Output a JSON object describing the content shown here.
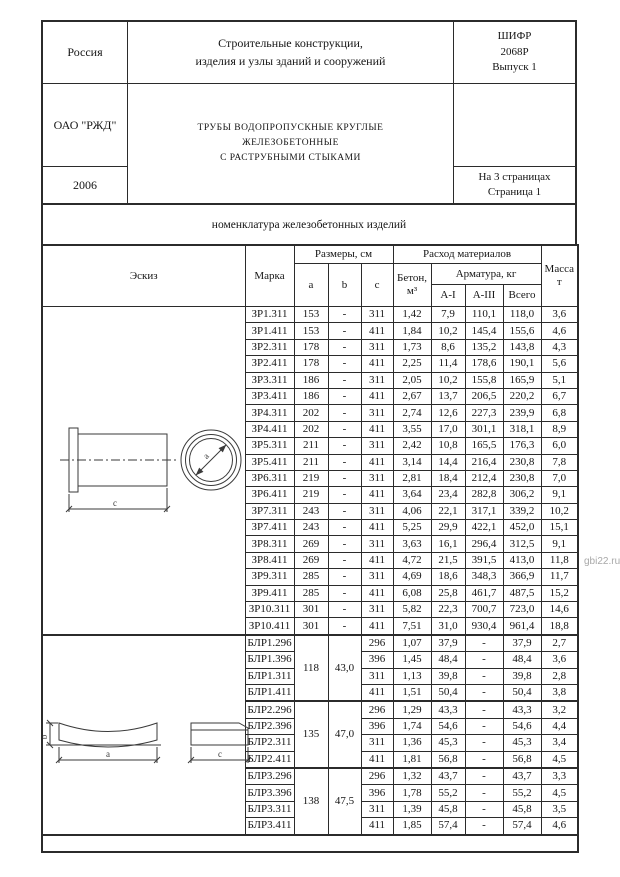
{
  "header": {
    "country": "Россия",
    "organization": "ОАО \"РЖД\"",
    "year": "2006",
    "series_title": "Строительные конструкции,\nизделия и узлы зданий и сооружений",
    "doc_title": "ТРУБЫ ВОДОПРОПУСКНЫЕ КРУГЛЫЕ\nЖЕЛЕЗОБЕТОННЫЕ\nС РАСТРУБНЫМИ СТЫКАМИ",
    "cipher": "ШИФР\n2068Р\nВыпуск 1",
    "pages": "На 3 страницах\nСтраница 1"
  },
  "section_title": "номенклатура железобетонных изделий",
  "table": {
    "columns": {
      "sketch": "Эскиз",
      "mark": "Марка",
      "dims": "Размеры, см",
      "a": "a",
      "b": "b",
      "c": "c",
      "consumption": "Расход материалов",
      "concrete": "Бетон,\nм³",
      "rebar": "Арматура, кг",
      "ai": "А-I",
      "aiii": "А-III",
      "total": "Всего",
      "mass": "Масса\nт"
    },
    "zr_rows": [
      [
        "ЗР1.311",
        "153",
        "-",
        "311",
        "1,42",
        "7,9",
        "110,1",
        "118,0",
        "3,6"
      ],
      [
        "ЗР1.411",
        "153",
        "-",
        "411",
        "1,84",
        "10,2",
        "145,4",
        "155,6",
        "4,6"
      ],
      [
        "ЗР2.311",
        "178",
        "-",
        "311",
        "1,73",
        "8,6",
        "135,2",
        "143,8",
        "4,3"
      ],
      [
        "ЗР2.411",
        "178",
        "-",
        "411",
        "2,25",
        "11,4",
        "178,6",
        "190,1",
        "5,6"
      ],
      [
        "ЗР3.311",
        "186",
        "-",
        "311",
        "2,05",
        "10,2",
        "155,8",
        "165,9",
        "5,1"
      ],
      [
        "ЗР3.411",
        "186",
        "-",
        "411",
        "2,67",
        "13,7",
        "206,5",
        "220,2",
        "6,7"
      ],
      [
        "ЗР4.311",
        "202",
        "-",
        "311",
        "2,74",
        "12,6",
        "227,3",
        "239,9",
        "6,8"
      ],
      [
        "ЗР4.411",
        "202",
        "-",
        "411",
        "3,55",
        "17,0",
        "301,1",
        "318,1",
        "8,9"
      ],
      [
        "ЗР5.311",
        "211",
        "-",
        "311",
        "2,42",
        "10,8",
        "165,5",
        "176,3",
        "6,0"
      ],
      [
        "ЗР5.411",
        "211",
        "-",
        "411",
        "3,14",
        "14,4",
        "216,4",
        "230,8",
        "7,8"
      ],
      [
        "ЗР6.311",
        "219",
        "-",
        "311",
        "2,81",
        "18,4",
        "212,4",
        "230,8",
        "7,0"
      ],
      [
        "ЗР6.411",
        "219",
        "-",
        "411",
        "3,64",
        "23,4",
        "282,8",
        "306,2",
        "9,1"
      ],
      [
        "ЗР7.311",
        "243",
        "-",
        "311",
        "4,06",
        "22,1",
        "317,1",
        "339,2",
        "10,2"
      ],
      [
        "ЗР7.411",
        "243",
        "-",
        "411",
        "5,25",
        "29,9",
        "422,1",
        "452,0",
        "15,1"
      ],
      [
        "ЗР8.311",
        "269",
        "-",
        "311",
        "3,63",
        "16,1",
        "296,4",
        "312,5",
        "9,1"
      ],
      [
        "ЗР8.411",
        "269",
        "-",
        "411",
        "4,72",
        "21,5",
        "391,5",
        "413,0",
        "11,8"
      ],
      [
        "ЗР9.311",
        "285",
        "-",
        "311",
        "4,69",
        "18,6",
        "348,3",
        "366,9",
        "11,7"
      ],
      [
        "ЗР9.411",
        "285",
        "-",
        "411",
        "6,08",
        "25,8",
        "461,7",
        "487,5",
        "15,2"
      ],
      [
        "ЗР10.311",
        "301",
        "-",
        "311",
        "5,82",
        "22,3",
        "700,7",
        "723,0",
        "14,6"
      ],
      [
        "ЗР10.411",
        "301",
        "-",
        "411",
        "7,51",
        "31,0",
        "930,4",
        "961,4",
        "18,8"
      ]
    ],
    "blr_groups": [
      {
        "a": "118",
        "b": "43,0",
        "rows": [
          [
            "БЛР1.296",
            "296",
            "1,07",
            "37,9",
            "-",
            "37,9",
            "2,7"
          ],
          [
            "БЛР1.396",
            "396",
            "1,45",
            "48,4",
            "-",
            "48,4",
            "3,6"
          ],
          [
            "БЛР1.311",
            "311",
            "1,13",
            "39,8",
            "-",
            "39,8",
            "2,8"
          ],
          [
            "БЛР1.411",
            "411",
            "1,51",
            "50,4",
            "-",
            "50,4",
            "3,8"
          ]
        ]
      },
      {
        "a": "135",
        "b": "47,0",
        "rows": [
          [
            "БЛР2.296",
            "296",
            "1,29",
            "43,3",
            "-",
            "43,3",
            "3,2"
          ],
          [
            "БЛР2.396",
            "396",
            "1,74",
            "54,6",
            "-",
            "54,6",
            "4,4"
          ],
          [
            "БЛР2.311",
            "311",
            "1,36",
            "45,3",
            "-",
            "45,3",
            "3,4"
          ],
          [
            "БЛР2.411",
            "411",
            "1,81",
            "56,8",
            "-",
            "56,8",
            "4,5"
          ]
        ]
      },
      {
        "a": "138",
        "b": "47,5",
        "rows": [
          [
            "БЛР3.296",
            "296",
            "1,32",
            "43,7",
            "-",
            "43,7",
            "3,3"
          ],
          [
            "БЛР3.396",
            "396",
            "1,78",
            "55,2",
            "-",
            "55,2",
            "4,5"
          ],
          [
            "БЛР3.311",
            "311",
            "1,39",
            "45,8",
            "-",
            "45,8",
            "3,5"
          ],
          [
            "БЛР3.411",
            "411",
            "1,85",
            "57,4",
            "-",
            "57,4",
            "4,6"
          ]
        ]
      }
    ]
  },
  "sketches": {
    "pipe": {
      "length_label": "c",
      "diameter_label": "a"
    },
    "saddle": {
      "width_label": "a",
      "height_label": "b",
      "length_label": "c"
    }
  },
  "watermark": "gbi22.ru"
}
